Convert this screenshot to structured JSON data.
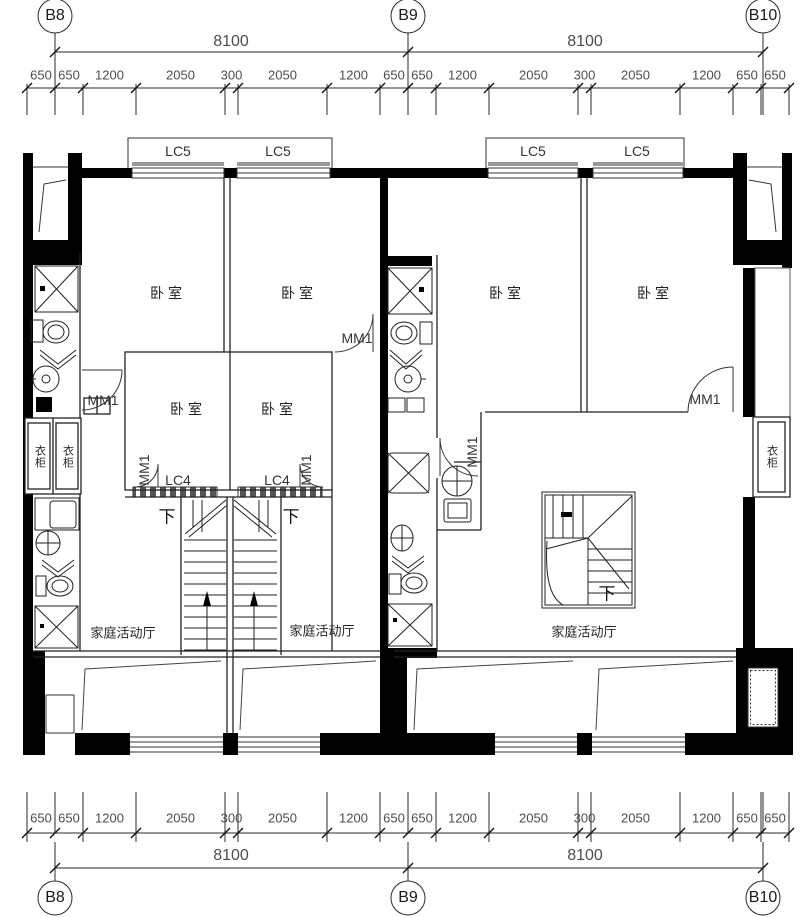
{
  "drawing": {
    "grid_labels": [
      "B8",
      "B9",
      "B10"
    ],
    "overall_dim": "8100",
    "segment_dims": [
      "650",
      "650",
      "1200",
      "2050",
      "300",
      "2050",
      "1200",
      "650",
      "650",
      "1200",
      "2050",
      "300",
      "2050",
      "1200",
      "650",
      "650"
    ],
    "window_tags": {
      "bay": "LC5",
      "stair": "LC4"
    },
    "door_tag": "MM1",
    "rooms": {
      "bedroom": "卧室",
      "family_hall": "家庭活动厅",
      "wardrobe": "衣柜"
    },
    "stair_down": "下",
    "colors": {
      "line": "#1a1a1a",
      "dim_text": "#4d4d4d",
      "wall": "#000000",
      "glass": "#999999"
    }
  }
}
